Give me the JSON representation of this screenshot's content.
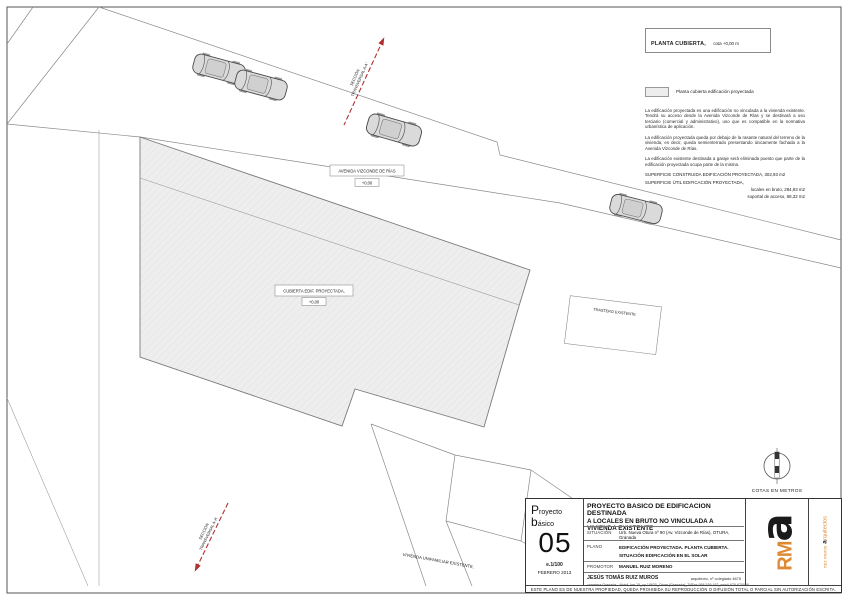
{
  "colors": {
    "roof_fill": "#ededed",
    "line_gray": "#7a7a7a",
    "section_red": "#b03030",
    "logo_orange": "#dd8a33"
  },
  "legend": {
    "title_bold": "PLANTA CUBIERTA,",
    "title_rest": "cota +0,00 m",
    "swatch_label": "Planta cubierta edificación proyectada",
    "paragraphs": [
      "La edificación proyectada es una edificación no vinculada a la vivienda existente. Tendrá su acceso desde la Avenida Vizconde de Rías y se destinará a uso terciario (comercial y administrativo), uso que es compatible en la normativa urbanística de aplicación.",
      "La edificación proyectada queda por debajo de la rasante natural del terreno de la vivienda, es decir, queda semienterrado presentando únicamente fachada a la Avenida Vizconde de Rías.",
      "La edificación existente destinada a garaje será eliminada puesto que parte de la edificación proyectada ocupa parte de la misma."
    ],
    "area_line1": "SUPERFICIE CONSTRUIDA EDIFICACIÓN PROYECTADA,  302,93 m2",
    "area_line2": "SUPERFICIE ÚTIL EDIFICACIÓN PROYECTADA,",
    "area_sub1": "locales en bruto, 284,93 m2",
    "area_sub2": "soportal de acceso, 88,32 m2"
  },
  "plan": {
    "road_label": "AVENIDA VIZCONDE DE RÍAS",
    "road_cota": "+0,00",
    "building_label": "CUBIERTA EDIF. PROYECTADA,",
    "building_cota": "+0,00",
    "trastero_label": "TRASTERO EXISTENTE",
    "vivienda_label": "VIVIENDA UNIFAMILIAR EXISTENTE,",
    "section_line1": "SECCIÓN",
    "section_line2": "TRANSVERSAL A-A'",
    "cotas_label": "COTAS EN METROS"
  },
  "titleblock": {
    "project_type_line1": "Proyecto",
    "project_type_line2": "básico",
    "sheet_number": "05",
    "scale": "e.1/100",
    "date": "FEBRERO 2013",
    "title_line1": "PROYECTO BASICO DE EDIFICACION DESTINADA",
    "title_line2": "A LOCALES EN BRUTO NO VINCULADA A VIVIENDA EXISTENTE",
    "situacion_label": "SITUACIÓN",
    "situacion_value": "Urb. Nueva Otura nº 90 (Av. Vizconde de Rías), OTURA, Granada",
    "plano_label": "PLANO",
    "plano_value_line1": "EDIFICACIÓN PROYECTADA. PLANTA CUBIERTA.",
    "plano_value_line2": "SITUACIÓN EDIFICACIÓN EN EL SOLAR",
    "promotor_label": "PROMOTOR",
    "promotor_value": "MANUEL RUIZ MORENO",
    "architect_name": "JESÚS TOMÁS RUIZ MUROS",
    "architect_title": "arquitecto, nº colegiado 4675",
    "architect_address": "carretera Granada - Motril, km 15_cp 18630_Otura (Granada)_Tf/Fax 958 539 162_móvil 678 670088",
    "logo_rm": "RM",
    "logo_a": "a",
    "logo_side_pre": "ruiz muros",
    "logo_side_a": "a",
    "logo_side_rest": "rquitectos",
    "disclaimer": "ESTE PLANO ES DE NUESTRA PROPIEDAD, QUEDA PROHIBIDA SU REPRODUCCIÓN O DIFUSIÓN TOTAL O PARCIAL SIN AUTORIZACIÓN ESCRITA."
  }
}
